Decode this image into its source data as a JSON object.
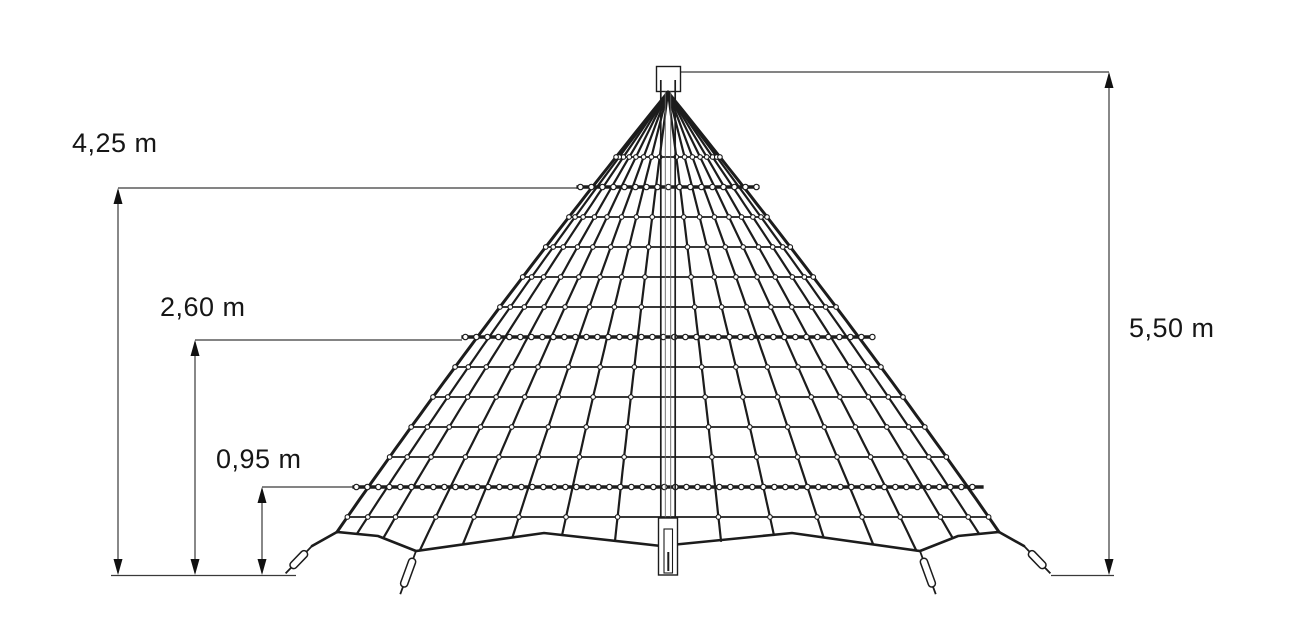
{
  "dimensions": [
    {
      "label": "4,25 m",
      "x": 118,
      "y1": 188,
      "y2": 575,
      "tick_y": 188,
      "tick_x2": 577,
      "label_left": 72,
      "label_top": 129
    },
    {
      "label": "2,60 m",
      "x": 195,
      "y1": 340,
      "y2": 575,
      "tick_y": 340,
      "tick_x2": 462,
      "label_left": 160,
      "label_top": 293
    },
    {
      "label": "0,95 m",
      "x": 262,
      "y1": 487,
      "y2": 575,
      "tick_y": 487,
      "tick_x2": 372,
      "label_left": 216,
      "label_top": 445
    },
    {
      "label": "5,50 m",
      "x": 1109,
      "y1": 72,
      "y2": 575,
      "tick_y": 72,
      "tick_x2": 680,
      "label_left": 1129,
      "label_top": 314
    }
  ],
  "figure": {
    "width": 1308,
    "height": 644,
    "line_color": "#1c1c1c",
    "dim_color": "#3a3a3a",
    "bg_color": "#ffffff",
    "center_x": 668,
    "apex_y": 92,
    "ground_y": 575,
    "edge_ctrl": {
      "dx1": 191,
      "y1": 329,
      "dx2": 331,
      "y2": 532
    },
    "cap": {
      "x": 656.5,
      "y": 66.5,
      "w": 24,
      "h": 25
    },
    "mast": {
      "outer_x": [
        660.8,
        675.2
      ],
      "inner_x": [
        665.3,
        670.7
      ],
      "top_y": 80,
      "base": {
        "x": 658.5,
        "y": 518,
        "w": 19,
        "h": 57,
        "ix": 664,
        "iy": 529,
        "iw": 8.5,
        "ih": 44
      }
    },
    "rings": {
      "plain_y": [
        157,
        217,
        247,
        277,
        307,
        367,
        397,
        427,
        457,
        517
      ],
      "beaded_y": [
        187,
        337,
        487
      ],
      "plain_overhang": 2,
      "beaded_overhang": 16,
      "bead_step": 11
    },
    "radial_fractions": [
      0.16,
      0.32,
      0.47,
      0.62,
      0.75,
      0.86,
      0.94
    ],
    "bottom_rope_left": [
      [
        312,
        546
      ],
      [
        337,
        532
      ],
      [
        378,
        536
      ],
      [
        416,
        551
      ],
      [
        544,
        533
      ],
      [
        661,
        546
      ]
    ],
    "anchors": [
      {
        "x": 312,
        "y": 546,
        "rot": 44,
        "len": 38
      },
      {
        "x": 416,
        "y": 551,
        "rot": 20,
        "len": 46
      },
      {
        "x": 920,
        "y": 551,
        "rot": -20,
        "len": 46
      },
      {
        "x": 1024,
        "y": 546,
        "rot": -44,
        "len": 38
      }
    ],
    "ground_segments": [
      [
        111,
        296
      ],
      [
        1051,
        1114
      ]
    ],
    "arrow": {
      "w": 9,
      "h": 16
    }
  }
}
